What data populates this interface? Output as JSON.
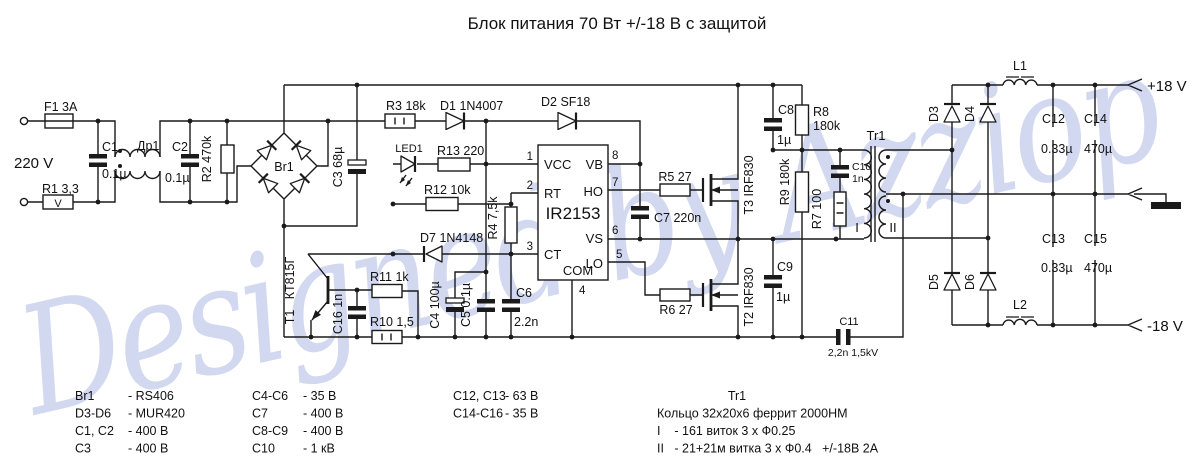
{
  "title": "Блок питания 70 Вт +/-18 В с защитой",
  "watermark": "Designed by Azziop",
  "labels": {
    "v220": "220 V",
    "f1": "F1  3A",
    "r1": "R1  3,3",
    "r1_sym": "V",
    "c1": "C1",
    "c1v": "0.1µ",
    "dr1": "Др1",
    "c2": "C2",
    "c2v": "0.1µ",
    "r2": "R2  470k",
    "br1": "Br1",
    "c3": "C3  68µ",
    "r3": "R3  18k",
    "d1": "D1  1N4007",
    "d2": "D2  SF18",
    "led1": "LED1",
    "r13": "R13  220",
    "r12": "R12  10k",
    "r4": "R4  7,5k",
    "d7": "D7  1N4148",
    "t1_name": "КТ815Г",
    "t1_ref": "T1",
    "c16": "C16  1n",
    "r11": "R11  1k",
    "r10": "R10  1,5",
    "c4": "C4  100µ",
    "c5": "C5  0.1µ",
    "c6": "C6",
    "c6v": "2.2n",
    "c7": "C7  220n",
    "r5": "R5  27",
    "r6": "R6  27",
    "t3": "T3  IRF830",
    "t2": "T2  IRF830",
    "c8": "C8",
    "c8v": "1µ",
    "r8a": "R8",
    "r8b": "180k",
    "c9": "C9",
    "c9v": "1µ",
    "r9": "R9  180k",
    "c10": "C10",
    "c10v": "1n",
    "r7": "R7  100",
    "tr1": "Tr1",
    "wI": "I",
    "wII": "II",
    "c11": "C11",
    "c11v": "2,2n 1,5kV",
    "d3": "D3",
    "d4": "D4",
    "d5": "D5",
    "d6": "D6",
    "l1": "L1",
    "l2": "L2",
    "c12": "C12",
    "c12v": "0.33µ",
    "c14": "C14",
    "c14v": "470µ",
    "c13": "C13",
    "c13v": "0.33µ",
    "c15": "C15",
    "c15v": "470µ",
    "out_pos": "+18 V",
    "out_neg": "-18 V",
    "ic_name": "IR2153",
    "pin_vcc": "VCC",
    "pin_rt": "RT",
    "pin_ct": "CT",
    "pin_com": "COM",
    "pin_vb": "VB",
    "pin_ho": "HO",
    "pin_vs": "VS",
    "pin_lo": "LO",
    "pn1": "1",
    "pn2": "2",
    "pn3": "3",
    "pn4": "4",
    "pn5": "5",
    "pn6": "6",
    "pn7": "7",
    "pn8": "8"
  },
  "bom": {
    "col1": [
      {
        "ref": "Br1",
        "val": "- RS406"
      },
      {
        "ref": "D3-D6",
        "val": "- MUR420"
      },
      {
        "ref": "C1, C2",
        "val": "- 400 В"
      },
      {
        "ref": "C3",
        "val": "- 400 В"
      }
    ],
    "col2": [
      {
        "ref": "C4-C6",
        "val": "- 35 В"
      },
      {
        "ref": "C7",
        "val": "- 400 В"
      },
      {
        "ref": "C8-C9",
        "val": "- 400 В"
      },
      {
        "ref": "C10",
        "val": "- 1 кВ"
      }
    ],
    "col3": [
      {
        "ref": "C12, C13",
        "val": "- 63 В"
      },
      {
        "ref": "C14-C16",
        "val": "- 35 В"
      }
    ],
    "tr1": {
      "title": "Tr1",
      "line1": "Кольцо 32х20х6 феррит 2000НМ",
      "line2": "I    - 161  виток  3 х Ф0.25",
      "line3": "II   - 21+21м витка  3 х Ф0.4   +/-18В  2А"
    }
  }
}
